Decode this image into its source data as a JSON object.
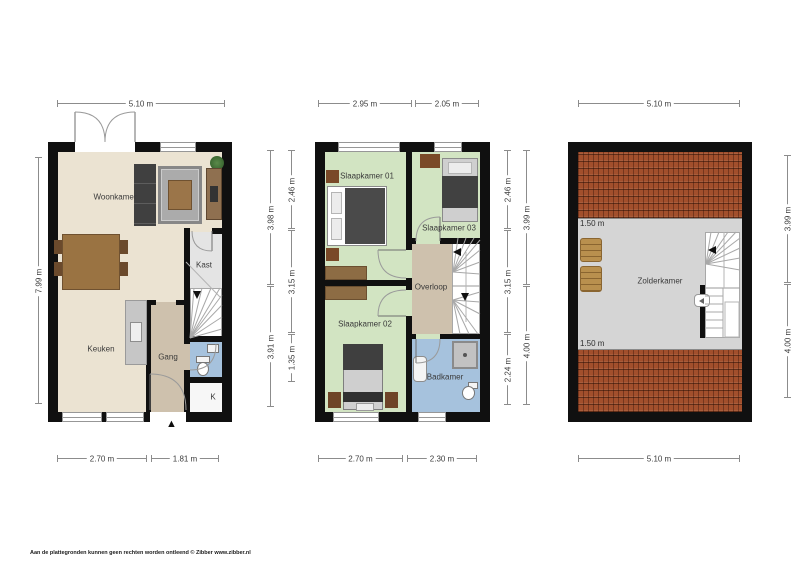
{
  "plans": {
    "ground": {
      "dims": {
        "top": "5.10 m",
        "left": "7.99 m",
        "bottom_left": "2.70 m",
        "bottom_right": "1.81 m"
      },
      "labels": {
        "woonkamer": "Woonkamer",
        "keuken": "Keuken",
        "gang": "Gang",
        "kast": "Kast",
        "meterkast": "K"
      }
    },
    "first": {
      "dims": {
        "top_left": "2.95 m",
        "top_right": "2.05 m",
        "bottom_left": "2.70 m",
        "bottom_right": "2.30 m",
        "left_outer_top": "3.98 m",
        "left_outer_bottom": "3.91 m",
        "left_inner_top": "2.46 m",
        "left_inner_middle": "3.15 m",
        "left_inner_bottom": "1.35 m",
        "right_inner_top": "2.46 m",
        "right_inner_middle": "3.15 m",
        "right_inner_bottom": "2.24 m",
        "right_outer_top": "3.99 m",
        "right_outer_bottom": "4.00 m"
      },
      "labels": {
        "slaapkamer01": "Slaapkamer 01",
        "slaapkamer02": "Slaapkamer 02",
        "slaapkamer03": "Slaapkamer 03",
        "overloop": "Overloop",
        "badkamer": "Badkamer"
      }
    },
    "attic": {
      "dims": {
        "top": "5.10 m",
        "bottom": "5.10 m",
        "right_top": "3.99 m",
        "right_bottom": "4.00 m"
      },
      "labels": {
        "zolderkamer": "Zolderkamer",
        "knee_height_top": "1.50 m",
        "knee_height_bottom": "1.50 m"
      }
    }
  },
  "icons": {
    "entrance_arrow": "▲"
  },
  "colors": {
    "wall": "#101010",
    "living_floor": "#ebe3d2",
    "bedroom_floor": "#d2e4c2",
    "hallway_floor": "#cec1ad",
    "bathroom_floor": "#a6c2dd",
    "closet_floor": "#e4e4e4",
    "attic_floor": "#d5d5d5",
    "roof_tiles": "#a24f2c"
  },
  "footer": {
    "credit": "Aan de plattegronden kunnen geen rechten worden ontleend © Zibber www.zibber.nl"
  }
}
